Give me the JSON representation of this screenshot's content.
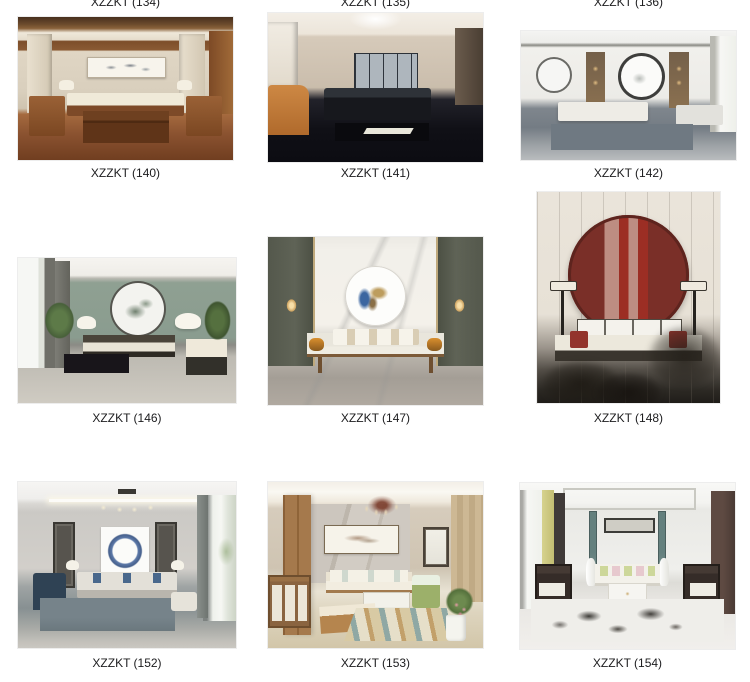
{
  "gallery": {
    "top_partial_labels": [
      {
        "label": "XZZKT (134)"
      },
      {
        "label": "XZZKT (135)"
      },
      {
        "label": "XZZKT (136)"
      }
    ],
    "items": [
      {
        "label": "XZZKT (140)",
        "description": "Chinese-style living room, wood coffered ceiling, horizontal ink painting, wooden armchairs, red-brown floor"
      },
      {
        "label": "XZZKT (141)",
        "description": "Modern living room, beige walls, four-panel artwork, black leather sofa, orange armchair, dark floor"
      },
      {
        "label": "XZZKT (142)",
        "description": "Light grey lounge, round mirror art, wood display cabinets, white sofa, bright window right"
      },
      {
        "label": "XZZKT (146)",
        "description": "Teal accent wall, round ink-wash art, dark-frame sofa with cream cushions, plants, mushroom lamps"
      },
      {
        "label": "XZZKT (147)",
        "description": "White marble wall, round blue-gold art, dark side panels with lanterns, wood daybed with orange bolsters"
      },
      {
        "label": "XZZKT (148)",
        "description": "Tall render, cream panel wall, large dark-red round pagoda artwork, floor lamps, white sofa with red pillows, blurred pine foreground"
      },
      {
        "label": "XZZKT (152)",
        "description": "Grey room, blue enso circle painting, grey sofa with blue pillows, chandelier, bright window right"
      },
      {
        "label": "XZZKT (153)",
        "description": "Warm room, marble wall with branch painting, red-brown chandelier, wood divider and cabinet, geometric rug, plants"
      },
      {
        "label": "XZZKT (154)",
        "description": "White symmetric room, long framed art, teal pattern strips, white sofa with green and pink pillows, dark armchairs, ink-splash rug"
      }
    ]
  },
  "accent": {
    "label_text_color": "#1c1c1e",
    "background": "#ffffff"
  }
}
